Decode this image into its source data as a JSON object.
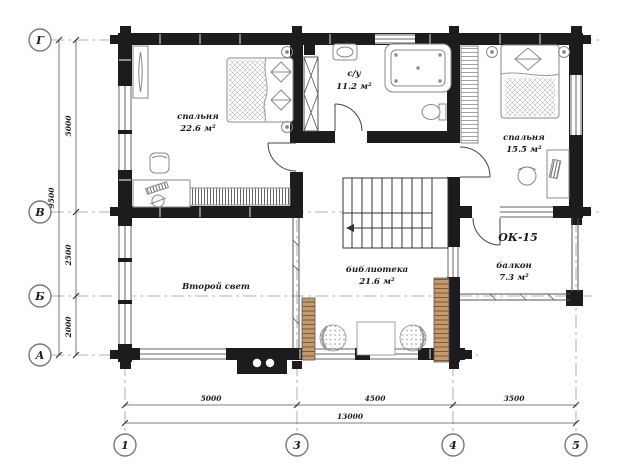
{
  "plan": {
    "rooms": {
      "bedroom1": {
        "name": "спальня",
        "area": "22.6 м²"
      },
      "bathroom": {
        "name": "с/у",
        "area": "11.2 м²"
      },
      "bedroom2": {
        "name": "спальня",
        "area": "15.5 м²"
      },
      "void_space": {
        "name": "Второй свет"
      },
      "library": {
        "name": "библиотека",
        "area": "21.6 м²"
      },
      "balcony": {
        "name": "балкон",
        "area": "7.3 м²"
      },
      "window_unit_mark": "ОК-15"
    },
    "axes": {
      "rows": [
        "Г",
        "В",
        "Б",
        "А"
      ],
      "cols": [
        "1",
        "3",
        "4",
        "5"
      ]
    },
    "dimensions": {
      "left_segments": [
        "5000",
        "2500",
        "2000"
      ],
      "left_total": "9500",
      "bottom_segments": [
        "5000",
        "4500",
        "3500"
      ],
      "bottom_total": "13000"
    },
    "colors": {
      "wall": "#1c1c1c",
      "furniture_line": "#777777",
      "shelf_wood": "#c49a6c",
      "grid_line": "#999999",
      "dimension_line": "#555555"
    }
  }
}
